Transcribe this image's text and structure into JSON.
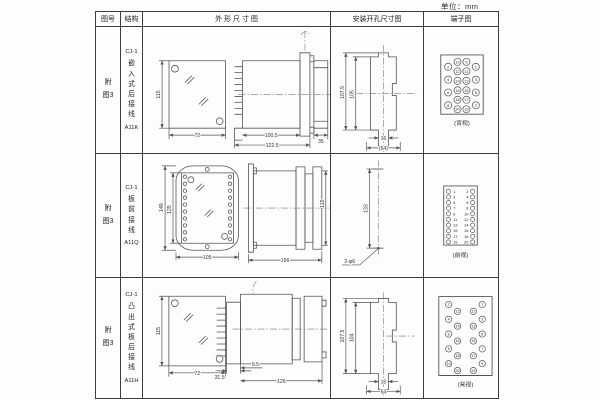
{
  "unit_label": "单位：mm",
  "headers": {
    "fig": "图号",
    "structure": "结构",
    "outline": "外 形 尺 寸 图",
    "install": "安装开孔尺寸图",
    "terminal": "端子图"
  },
  "rows": [
    {
      "fig": "附图3",
      "structure": {
        "model": "CJ-1",
        "desc": "嵌入式后接线",
        "code": "A11K"
      },
      "outline_dims": {
        "front_h": "115",
        "front_w": "72",
        "side_inner": "100.5",
        "side_outer": "122.5",
        "side_plug": "35"
      },
      "install_dims": {
        "outer_h": "107.5",
        "inner_h": "105",
        "slot_w": "16",
        "hole_span": "(64)"
      },
      "terminal": {
        "kind": "rear-grid",
        "label": "(背视)",
        "outer_left": [
          2,
          4,
          6,
          8
        ],
        "mid_left": [
          10,
          12,
          14,
          16,
          18,
          20
        ],
        "mid_right": [
          9,
          11,
          13,
          15,
          17,
          19
        ],
        "outer_right": [
          1,
          3,
          5,
          7
        ]
      }
    },
    {
      "fig": "附图3",
      "structure": {
        "model": "CJ-1",
        "desc": "板前接线",
        "code": "A11Q"
      },
      "outline_dims": {
        "front_outer_h": "149",
        "front_inner_h": "125",
        "front_w": "105",
        "side_len": "156",
        "side_h": "115"
      },
      "install_dims": {
        "hole_span": "133",
        "hole_label": "2-φ6"
      },
      "terminal": {
        "kind": "front-list",
        "label": "(前视)",
        "pairs": [
          [
            1,
            2
          ],
          [
            3,
            4
          ],
          [
            5,
            6
          ],
          [
            7,
            8
          ],
          [
            9,
            10
          ],
          [
            11,
            12
          ],
          [
            13,
            14
          ],
          [
            15,
            16
          ],
          [
            17,
            18
          ],
          [
            19,
            20
          ]
        ]
      }
    },
    {
      "fig": "附图3",
      "structure": {
        "model": "CJ-1",
        "desc": "凸出式板后接线",
        "code": "A11H"
      },
      "outline_dims": {
        "front_h": "115",
        "front_w": "72",
        "side_base": "31.5",
        "side_step": "9.5",
        "side_len": "126"
      },
      "install_dims": {
        "outer_h": "107.5",
        "inner_h": "104",
        "slot_w": "16",
        "hole_span": "64"
      },
      "terminal": {
        "kind": "stagger",
        "label": "(背视)",
        "cols": [
          [
            2,
            4,
            6,
            8,
            10
          ],
          [
            12,
            14,
            16,
            18,
            20
          ],
          [
            11,
            13,
            15,
            17,
            19
          ],
          [
            1,
            3,
            5,
            7,
            9
          ]
        ]
      }
    }
  ]
}
